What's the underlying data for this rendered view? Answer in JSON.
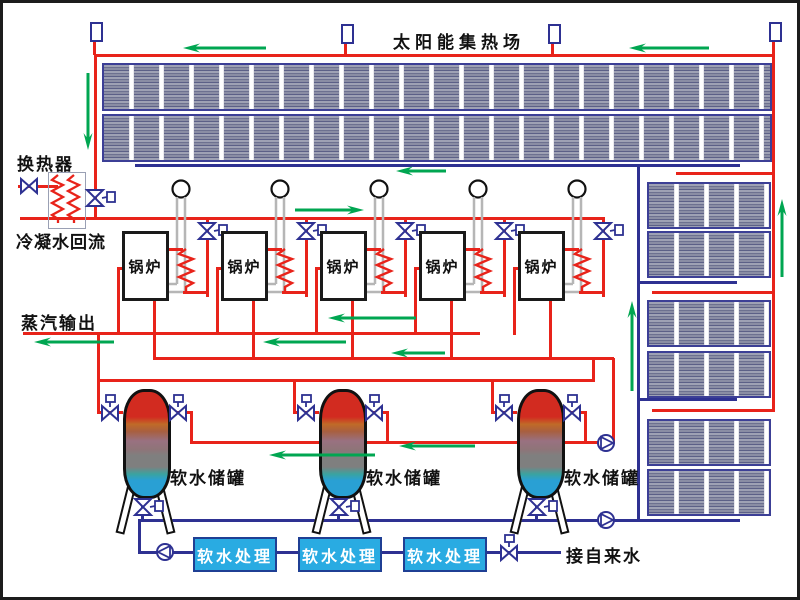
{
  "title": "太阳能集热场",
  "labels": {
    "heat_exchanger": "换热器",
    "condensate_return": "冷凝水回流",
    "steam_output": "蒸汽输出",
    "boiler": "锅炉",
    "soft_water_tank": "软水储罐",
    "soft_water_treatment": "软水处理",
    "tap_water": "接自来水"
  },
  "counts": {
    "boilers": 5,
    "tanks": 3,
    "treatment_units": 3,
    "collector_rows_top": 2,
    "collector_groups_right": 3,
    "top_sensors": 4
  },
  "colors": {
    "hot_pipe": "#e8231a",
    "cold_pipe": "#2e3192",
    "flow_arrow": "#00a651",
    "treatment_box": "#29abe2",
    "panel_body": "#9093ab",
    "tank_top": "#d22b20",
    "tank_bottom": "#29a0d4"
  }
}
